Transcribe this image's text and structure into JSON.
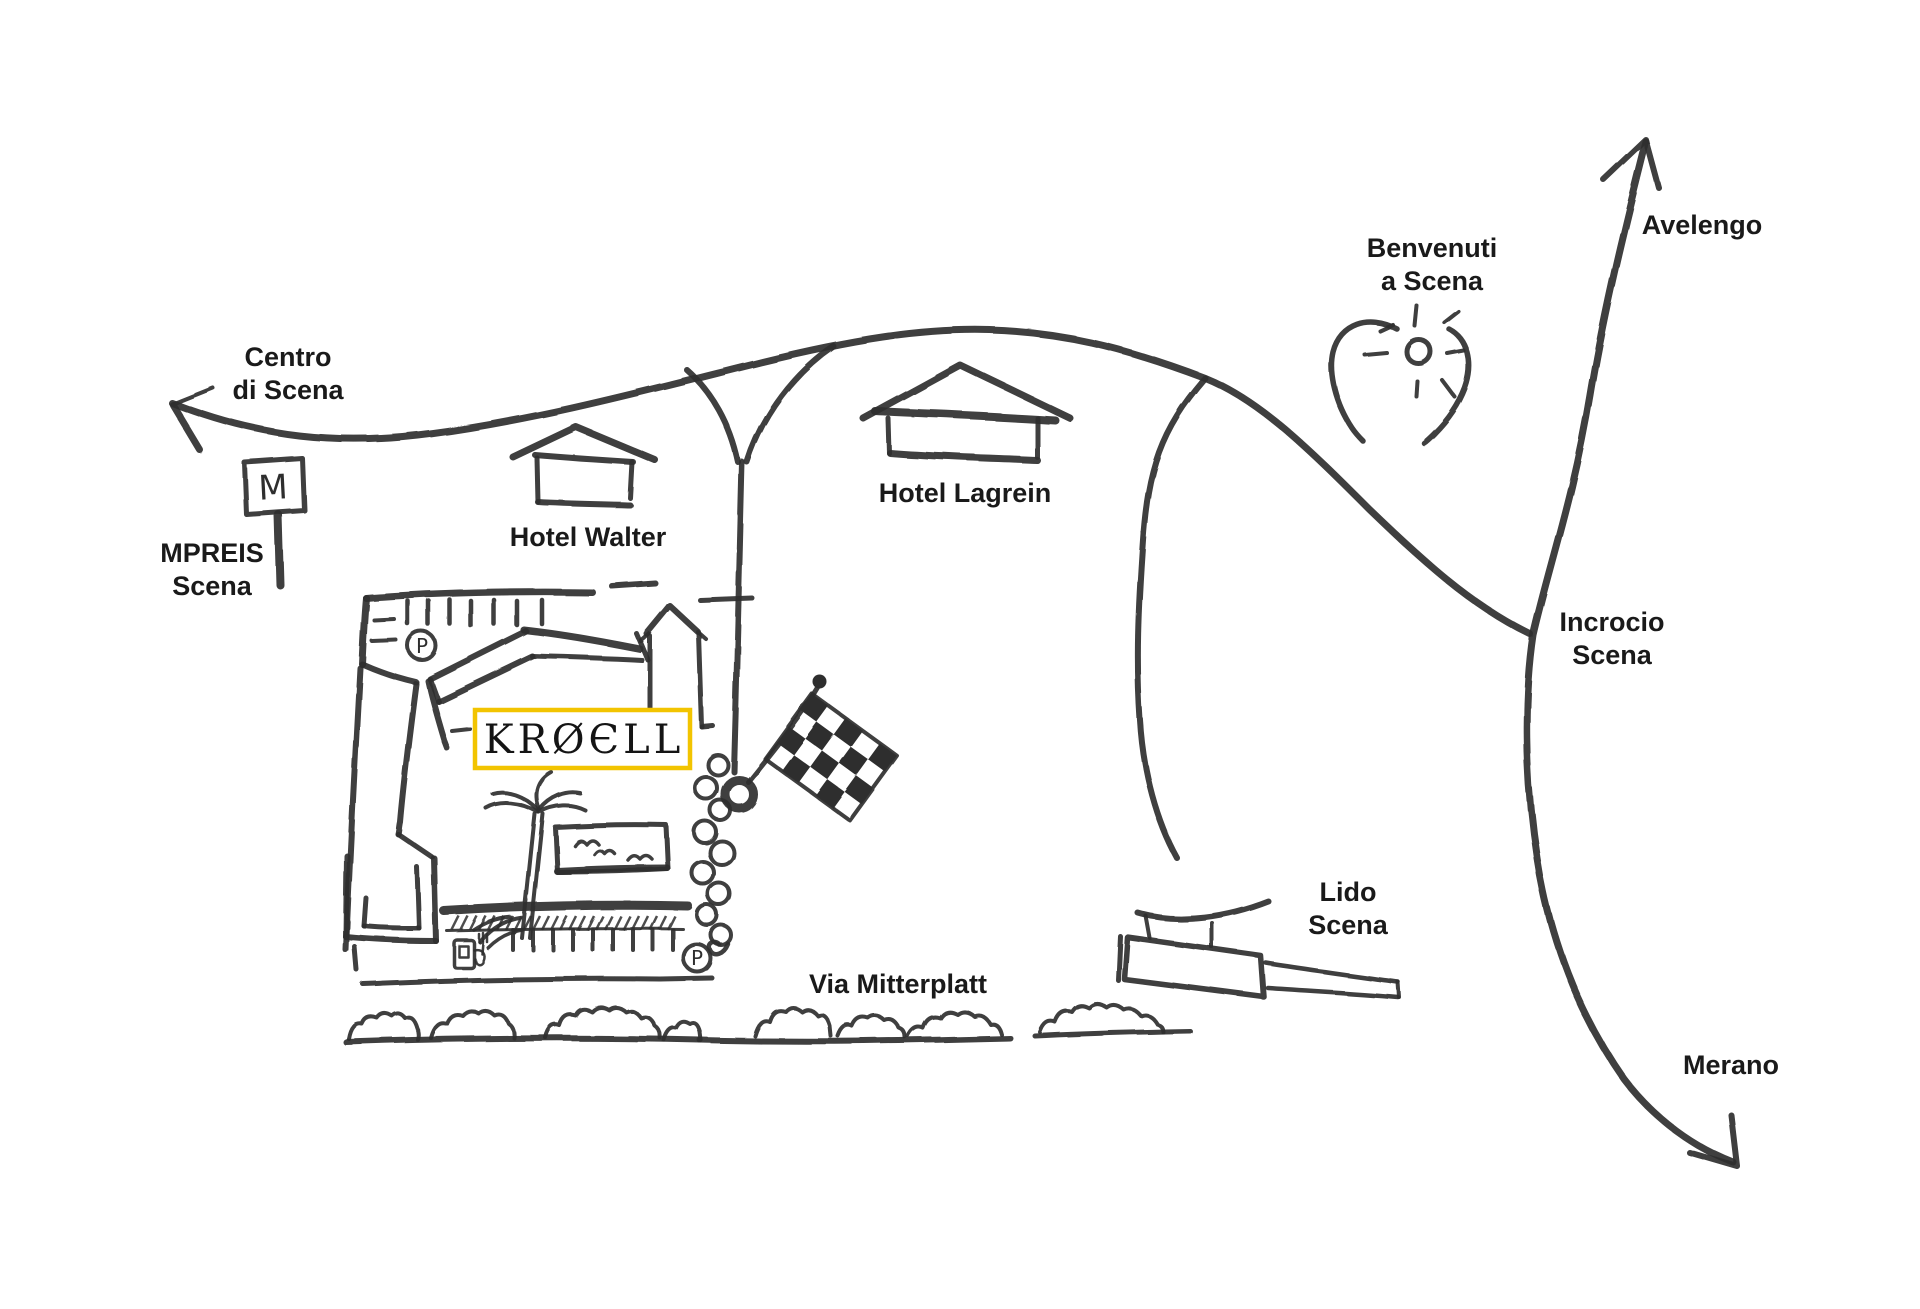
{
  "map": {
    "logo": "KRØЄLL",
    "labels": {
      "centro": {
        "line1": "Centro",
        "line2": "di Scena"
      },
      "mpreis": {
        "line1": "MPREIS",
        "line2": "Scena"
      },
      "hotel_walter": "Hotel Walter",
      "hotel_lagrein": "Hotel Lagrein",
      "benvenuti": {
        "line1": "Benvenuti",
        "line2": "a Scena"
      },
      "avelengo": "Avelengo",
      "incrocio": {
        "line1": "Incrocio",
        "line2": "Scena"
      },
      "lido": {
        "line1": "Lido",
        "line2": "Scena"
      },
      "via_mitterplatt": "Via Mitterplatt",
      "merano": "Merano",
      "m_sign": "M",
      "parking": "P"
    },
    "colors": {
      "ink": "#2e2e2e",
      "text": "#1a1a1a",
      "logo_border": "#F2C400",
      "background": "#ffffff"
    }
  }
}
